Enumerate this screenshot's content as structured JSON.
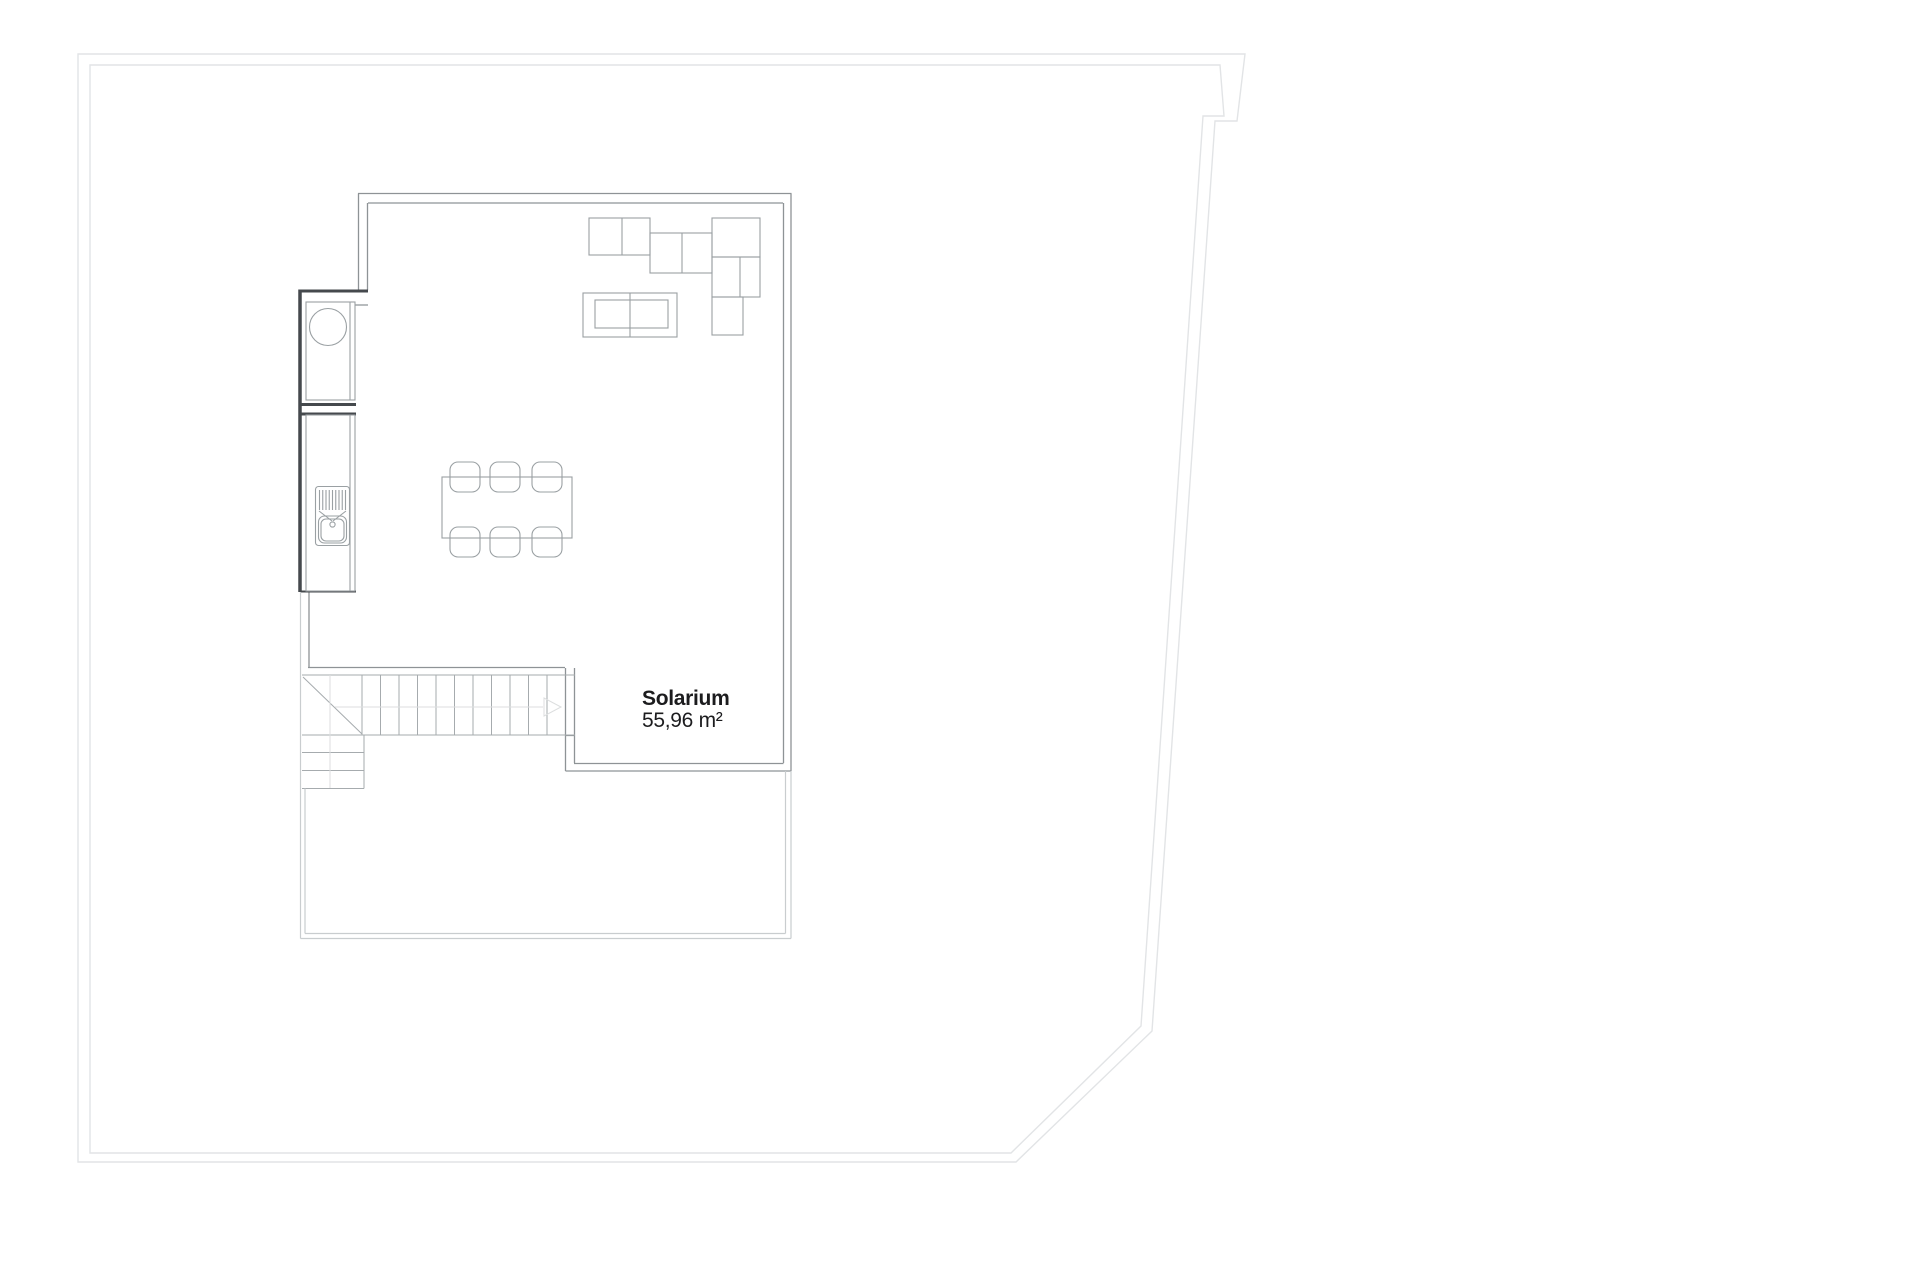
{
  "room": {
    "label": "Solarium",
    "area": "55,96 m²"
  },
  "colors": {
    "background": "#ffffff",
    "boundary_line": "#e2e4e6",
    "wall_line": "#8e9396",
    "dark_wall_line": "#45494d",
    "furniture_line": "#9aa0a3",
    "stair_line": "#a6abae",
    "terrace_line": "#c9cdcf",
    "faint_line": "#dcdedf",
    "label_text": "#1c1c1e"
  }
}
